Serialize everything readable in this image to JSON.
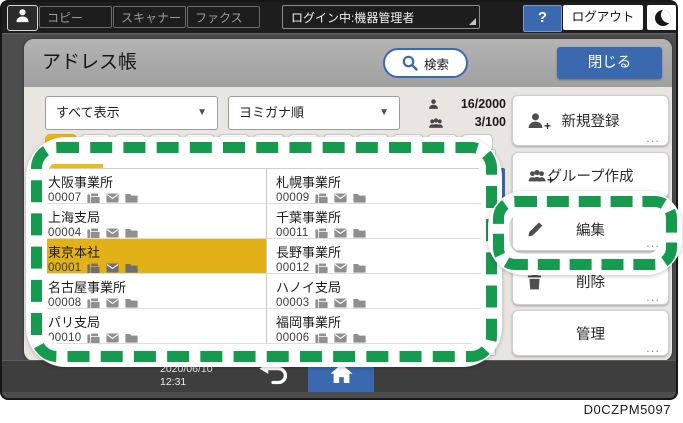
{
  "topbar": {
    "tabs": [
      "コピー",
      "スキャナー",
      "ファクス"
    ],
    "login_status": "ログイン中:機器管理者",
    "help_label": "?",
    "logout_label": "ログアウト"
  },
  "header": {
    "title": "アドレス帳",
    "search_label": "検索",
    "close_label": "閉じる"
  },
  "toolbar": {
    "view_filter": "すべて表示",
    "sort_order": "ヨミガナ順",
    "entry_count": "16/2000",
    "group_count": "3/100",
    "caret": "▼"
  },
  "list": {
    "cells": [
      {
        "name": "大阪事業所",
        "number": "00007"
      },
      {
        "name": "札幌事業所",
        "number": "00009"
      },
      {
        "name": "上海支局",
        "number": "00004"
      },
      {
        "name": "千葉事業所",
        "number": "00011"
      },
      {
        "name": "東京本社",
        "number": "00001",
        "selected": true
      },
      {
        "name": "長野事業所",
        "number": "00012"
      },
      {
        "name": "名古屋事業所",
        "number": "00008"
      },
      {
        "name": "ハノイ支局",
        "number": "00003"
      },
      {
        "name": "パリ支局",
        "number": "00010"
      },
      {
        "name": "福岡事業所",
        "number": "00006"
      }
    ]
  },
  "actions": {
    "register": "新規登録",
    "create_group": "グループ作成",
    "edit": "編集",
    "delete": "削除",
    "manage": "管理",
    "more": "...",
    "plus": "+"
  },
  "bottombar": {
    "date": "2020/06/10",
    "time": "12:31"
  },
  "caption": "D0CZPM5097",
  "icons": {
    "user": "person-silhouette",
    "help": "question-mark",
    "sleep": "crescent-moon",
    "search": "magnifier",
    "entry_counter": "single-person",
    "group_counter": "three-people",
    "contact_fax": "fax-machine",
    "contact_mail": "envelope",
    "contact_folder": "folder",
    "register": "person-plus",
    "create_group": "people-plus",
    "edit": "pencil",
    "delete": "trash-can",
    "back": "curved-return-arrow",
    "home": "house"
  },
  "colors": {
    "accent_blue": "#3a69b0",
    "selection_yellow": "#e2b117",
    "annotation_green": "#169a4e",
    "topbar_dark": "#1d1d1d"
  }
}
